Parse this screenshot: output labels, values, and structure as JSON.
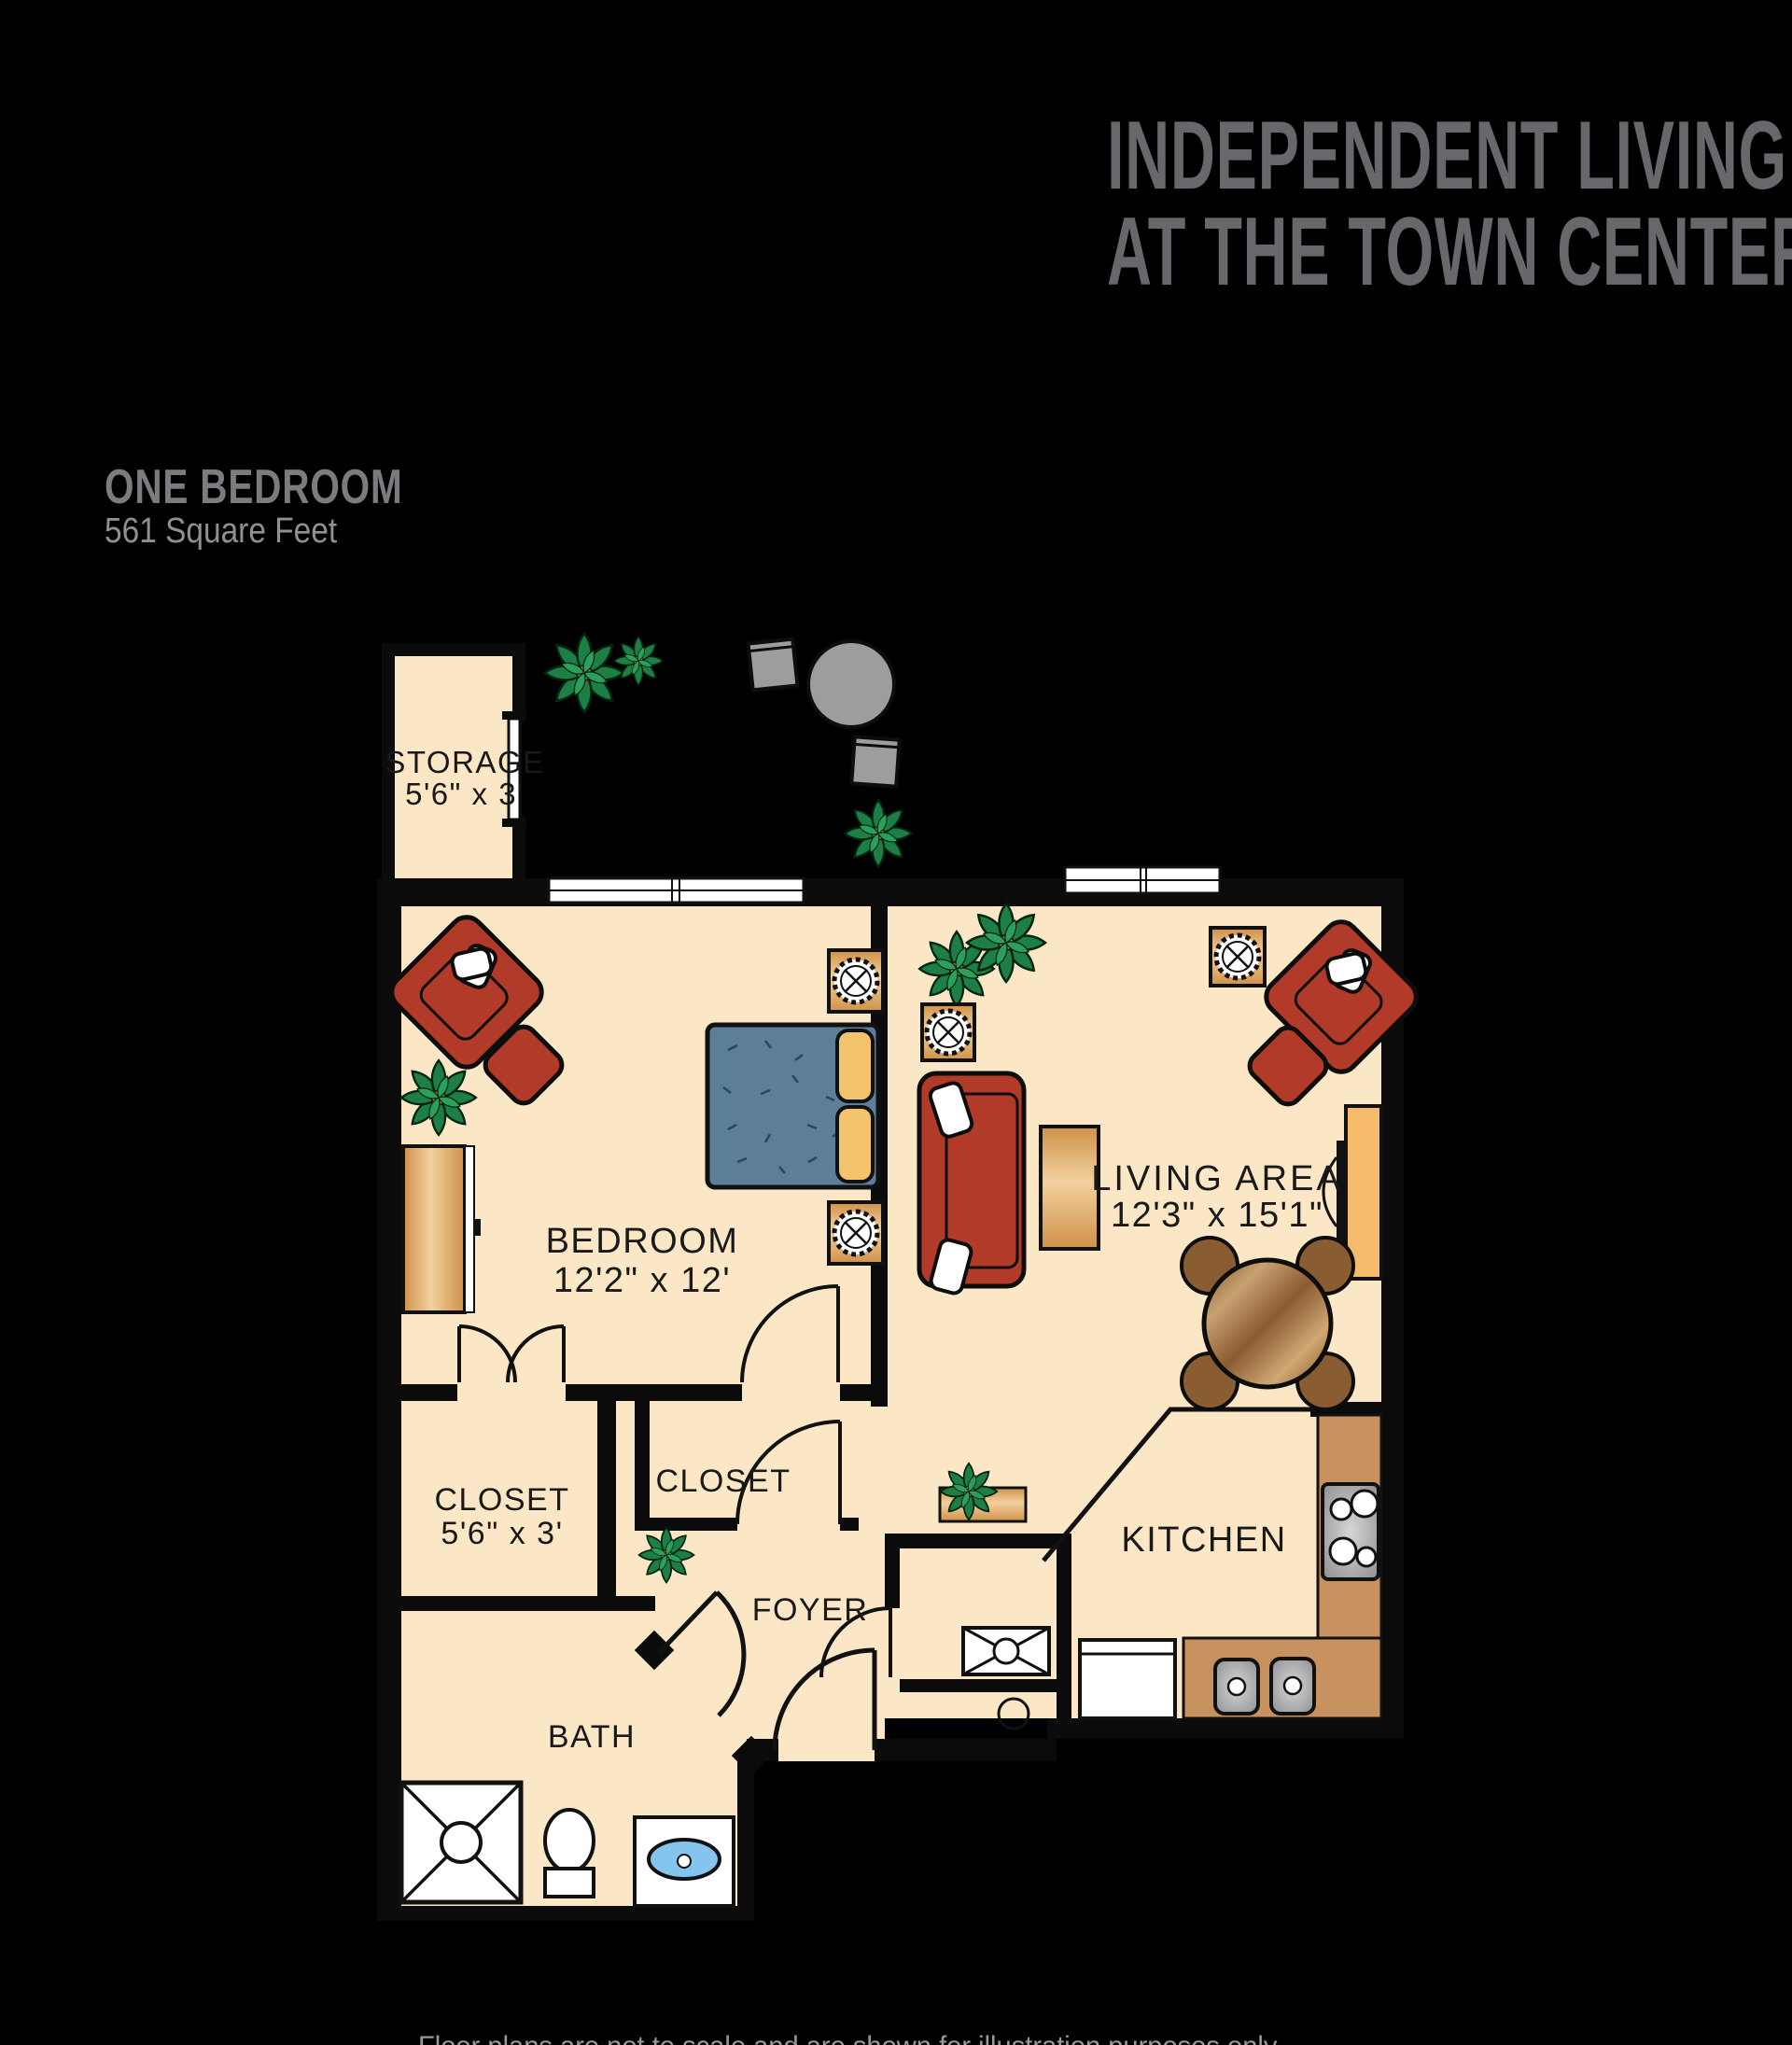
{
  "header": {
    "title_line1": "INDEPENDENT LIVING",
    "title_line2": "AT THE TOWN CENTER"
  },
  "plan": {
    "name": "ONE BEDROOM",
    "area": "561 Square Feet"
  },
  "rooms": {
    "storage": {
      "label": "STORAGE",
      "dims": "5'6\" x 3'"
    },
    "bedroom": {
      "label": "BEDROOM",
      "dims": "12'2\" x 12'"
    },
    "living": {
      "label": "LIVING AREA",
      "dims": "12'3\" x 15'1\""
    },
    "closet_bedroom": {
      "label": "CLOSET",
      "dims": "5'6\" x 3'"
    },
    "closet_hall": {
      "label": "CLOSET"
    },
    "foyer": {
      "label": "FOYER"
    },
    "bath": {
      "label": "BATH"
    },
    "kitchen": {
      "label": "KITCHEN"
    }
  },
  "caption": {
    "text": "Floor plans are not to scale and are shown for illustration purposes only."
  },
  "colors": {
    "background": "#000000",
    "floor": "#FBE7C6",
    "wall": "#0b0b0b",
    "furniture_red": "#B23A28",
    "bed_blue": "#5C7E99",
    "pillow_tan": "#F3C36E",
    "wood": "#E2A95E",
    "counter_brown": "#C89160",
    "patio_grey": "#9D9D9D",
    "plant_green": "#1D7F45",
    "sink_blue": "#85C4EC",
    "title_grey": "#67676C"
  }
}
